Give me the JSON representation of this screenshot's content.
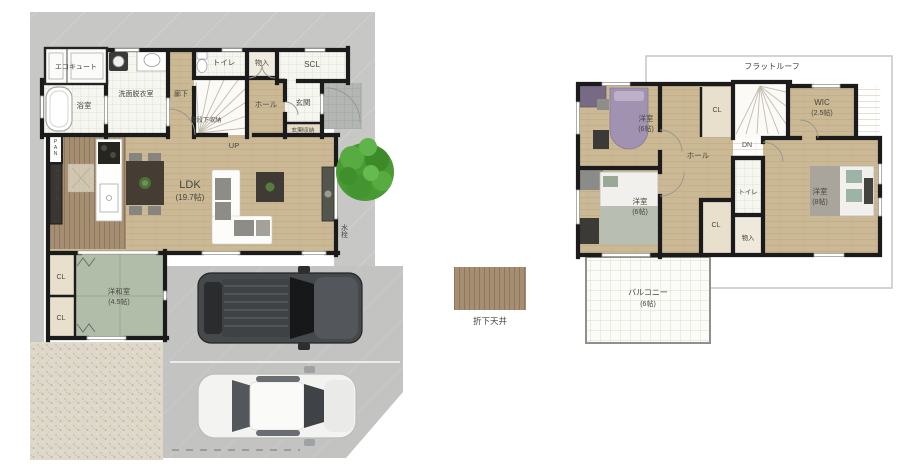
{
  "floor1": {
    "ecocute": "エコキュート",
    "bath": "浴室",
    "washroom": "洗面脱衣室",
    "corridor": "廊下",
    "toilet": "トイレ",
    "storage": "物入",
    "scl": "SCL",
    "hall": "ホール",
    "entrance": "玄関",
    "entrance_storage": "玄関収納",
    "under_stair_storage": "階段下収納",
    "up": "UP",
    "pan": "PAN",
    "cupboard": "カップボード",
    "ldk": "LDK",
    "ldk_size": "(19.7帖)",
    "japanese_room": "洋和室",
    "japanese_room_size": "(4.5帖)",
    "closet": "CL",
    "faucet": "水栓"
  },
  "floor2": {
    "flat_roof": "フラットルーフ",
    "bedroom_nw": "洋室",
    "bedroom_nw_size": "(6帖)",
    "bedroom_sw": "洋室",
    "bedroom_sw_size": "(6帖)",
    "bedroom_e": "洋室",
    "bedroom_e_size": "(8帖)",
    "wic": "WIC",
    "wic_size": "(2.5帖)",
    "closet_top": "CL",
    "closet_bottom": "CL",
    "dn": "DN",
    "hall": "ホール",
    "toilet": "トイレ",
    "storage": "物入",
    "balcony": "バルコニー",
    "balcony_size": "(6帖)"
  },
  "legend": {
    "lowered_ceiling": "折下天井"
  },
  "colors": {
    "wall": "#1b1b1b",
    "wood_floor": "#cbb894",
    "lowered_ceiling_brown": "#a58e72",
    "tatami_green": "#b2bda9",
    "site_concrete": "#c7c7c5",
    "gravel": "#ddd8c9",
    "tree_green": "#4a9a33",
    "bed_purple": "#a292b2"
  }
}
